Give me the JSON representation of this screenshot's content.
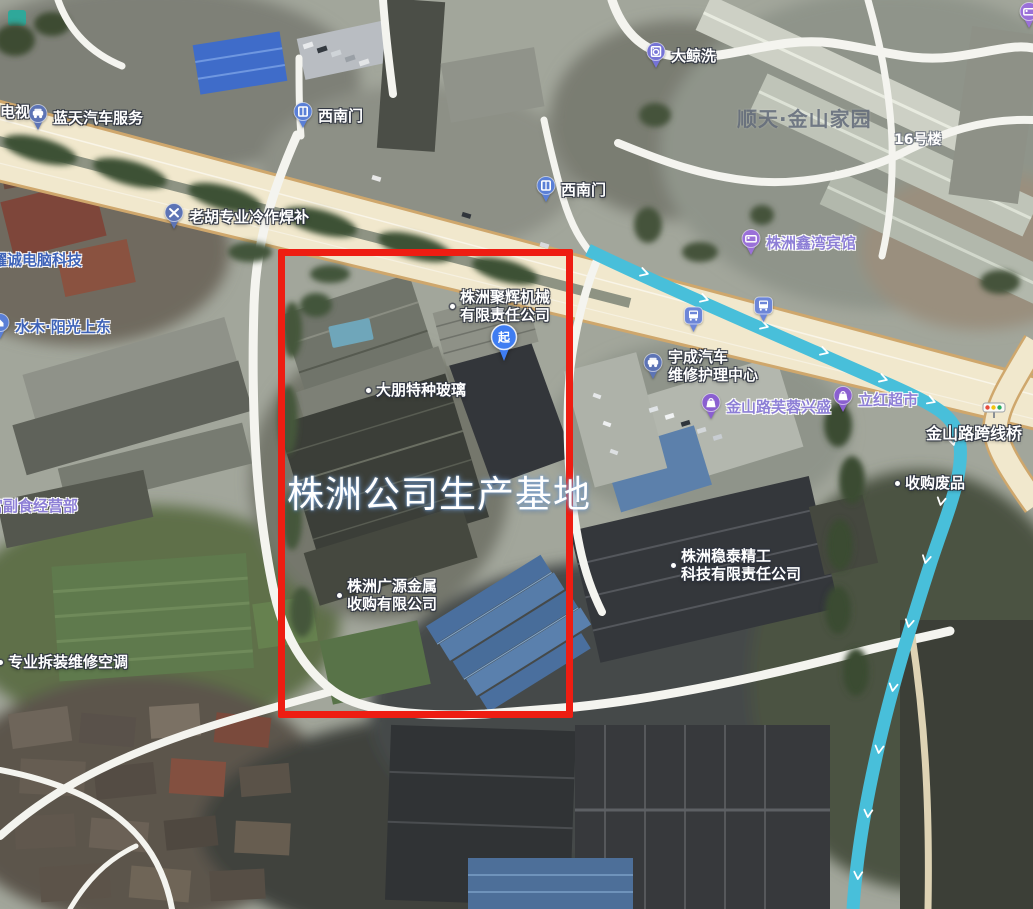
{
  "annotation": {
    "box_label": "株洲公司生产基地"
  },
  "start_pin": {
    "label": "起"
  },
  "watermark": {
    "text": "顺天·金山家园"
  },
  "poi": {
    "tv_partial": {
      "text": "电视"
    },
    "lantian_auto": {
      "text": "蓝天汽车服务"
    },
    "gate_southwest_upper": {
      "text": "西南门"
    },
    "gate_southwest_lower": {
      "text": "西南门"
    },
    "dajing_wash": {
      "text": "大鲸洗"
    },
    "building_16": {
      "text": "16号楼"
    },
    "laohu_welding": {
      "text": "老胡专业冷作焊补"
    },
    "yaocheng_computer": {
      "text": "耀诚电脑科技"
    },
    "zhuzhou_xinwan_hotel": {
      "text": "株洲鑫湾宾馆"
    },
    "shuimu_sunshine": {
      "text": "水木·阳光上东"
    },
    "juhui_machinery": {
      "line1": "株洲聚辉机械",
      "line2": "有限责任公司"
    },
    "dapeng_glass": {
      "text": "大朋特种玻璃"
    },
    "yucheng_auto": {
      "line1": "宇成汽车",
      "line2": "维修护理中心"
    },
    "jinshanlu_furong": {
      "text": "金山路芙蓉兴盛"
    },
    "lihong_market": {
      "text": "立红超市"
    },
    "jinshan_bridge": {
      "text": "金山路跨线桥"
    },
    "scrap_recycling": {
      "text": "收购废品"
    },
    "wentai_tech": {
      "line1": "株洲稳泰精工",
      "line2": "科技有限责任公司"
    },
    "guangyuan_metal": {
      "line1": "株洲广源金属",
      "line2": "收购有限公司"
    },
    "fushi_shop": {
      "text": "宫副食经营部"
    },
    "ac_repair": {
      "text": "专业拆装维修空调"
    }
  },
  "icons": {
    "car_pin": "car",
    "gate_pin": "door",
    "wash_pin": "washer",
    "tools_pin": "crossed-tools",
    "bed_pin": "hotel-bed",
    "bag_pin": "shopping-bag",
    "bus_pin": "bus",
    "house_pin": "house",
    "start_pin": "blue-route-start-pin",
    "traffic_light": "three-light-signal",
    "poi_dot": "white-dot-marker"
  },
  "colors": {
    "annotation_red": "#ee1d12",
    "river_cyan": "#48bfda",
    "road_beige": "#f1e8cd",
    "road_casing": "#cfa76c",
    "poi_text_white": "#ffffff",
    "poi_text_blue": "#3e63b8",
    "poi_text_purple": "#8d7fd6",
    "pin_blue": "#5a7fd6",
    "pin_purple": "#8a5fd0",
    "start_pin_blue": "#3f7df2"
  }
}
